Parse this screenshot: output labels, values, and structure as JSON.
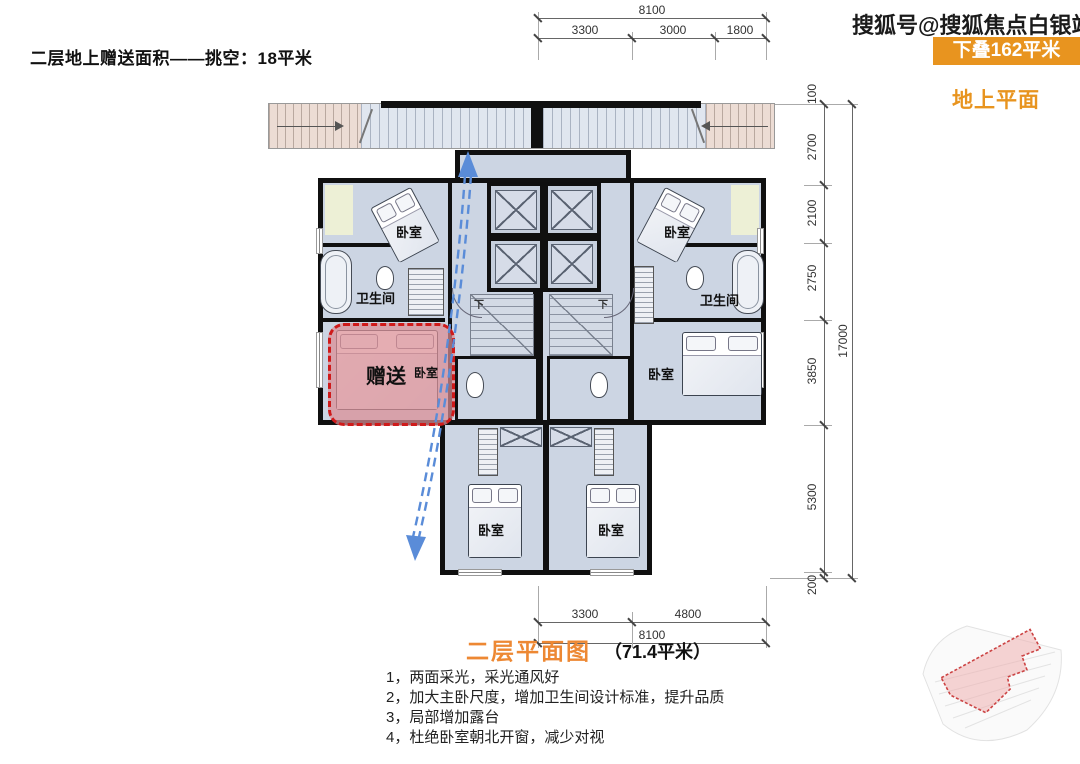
{
  "header": {
    "left_note": "二层地上赠送面积——挑空：18平米",
    "watermark": "搜狐号@搜狐焦点白银站",
    "badge": "下叠162平米",
    "floor_tag": "地上平面"
  },
  "colors": {
    "accent_orange": "#e8941f",
    "title_orange": "#ed8833",
    "bonus_red": "#cf1a1a",
    "bonus_fill": "#dca9ae",
    "arrow_blue": "#5a8cd8",
    "floor_fill": "#ccd5e3"
  },
  "plan": {
    "labels": {
      "bedroom": "卧室",
      "bathroom": "卫生间",
      "bonus": "赠送",
      "stair_down": "下"
    }
  },
  "dims": {
    "top": {
      "overall": "8100",
      "segments": [
        "3300",
        "3000",
        "1800"
      ]
    },
    "bottom": {
      "overall": "8100",
      "segments": [
        "3300",
        "4800"
      ]
    },
    "right": {
      "overall": "17000",
      "segments": [
        "100",
        "2700",
        "2100",
        "2750",
        "3850",
        "5300",
        "200"
      ]
    }
  },
  "footer": {
    "title": "二层平面图",
    "area_note": "（71.4平米）",
    "notes": [
      "1，两面采光，采光通风好",
      "2，加大主卧尺度，增加卫生间设计标准，提升品质",
      "3，局部增加露台",
      "4，杜绝卧室朝北开窗，减少对视"
    ]
  }
}
